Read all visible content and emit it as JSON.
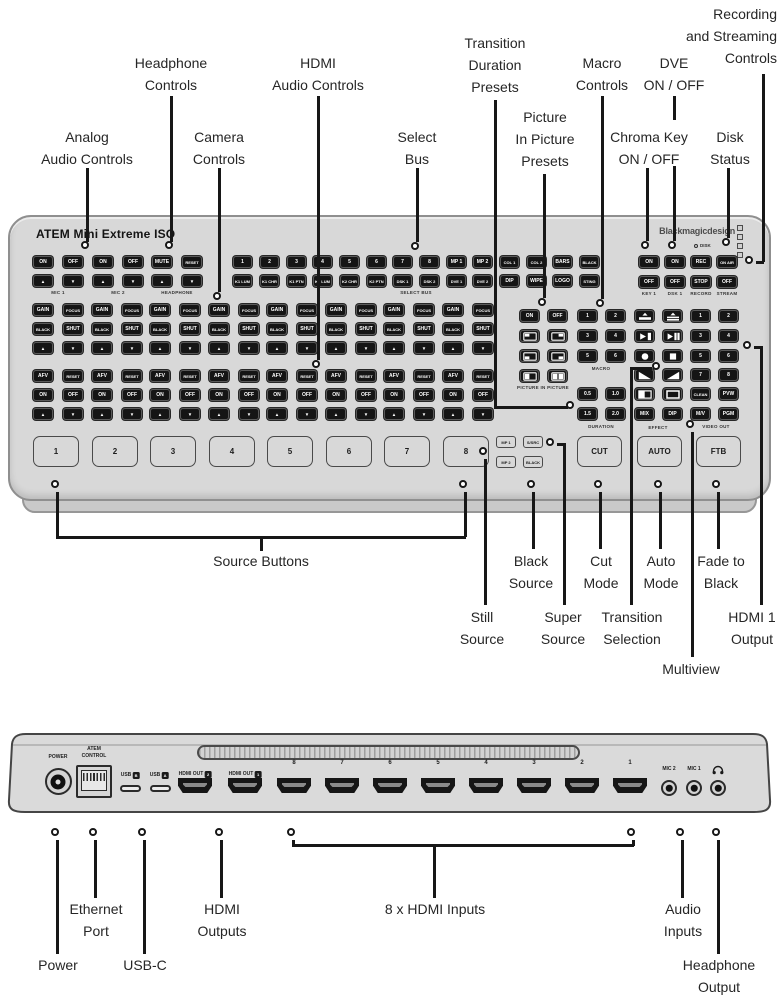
{
  "colors": {
    "panel": "#d8d8d8",
    "key": "#151515",
    "key_text": "#ffffff",
    "line": "#1a1a1a",
    "label_text": "#262626"
  },
  "front_panel": {
    "title": "ATEM Mini Extreme ISO",
    "brand": "Blackmagicdesign",
    "audio_groups": [
      {
        "label": "MIC 1",
        "rows": [
          [
            "ON",
            "OFF"
          ],
          [
            "▲",
            "▼"
          ]
        ]
      },
      {
        "label": "MIC 2",
        "rows": [
          [
            "ON",
            "OFF"
          ],
          [
            "▲",
            "▼"
          ]
        ]
      },
      {
        "label": "HEADPHONE",
        "rows": [
          [
            "MUTE",
            "RESET"
          ],
          [
            "▲",
            "▼"
          ]
        ]
      }
    ],
    "select_bus": {
      "label": "SELECT BUS",
      "row1": [
        "1",
        "2",
        "3",
        "4",
        "5",
        "6",
        "7",
        "8",
        "MP 1",
        "MP 2",
        "COL 1",
        "COL 2",
        "BARS",
        "BLACK"
      ],
      "row2": [
        "K1 LUM",
        "K1 CHR",
        "K1 PTN",
        "K2 LUM",
        "K2 CHR",
        "K2 PTN",
        "DSK 1",
        "DSK 2",
        "DVE 1",
        "DVE 2",
        "DIP",
        "WIPE",
        "LOGO",
        "STING"
      ]
    },
    "record_group": {
      "disk_led": "DISK",
      "columns": [
        {
          "top": "ON",
          "bottom": "OFF",
          "label": "KEY 1"
        },
        {
          "top": "ON",
          "bottom": "OFF",
          "label": "DSK 1"
        },
        {
          "top": "REC",
          "bottom": "STOP",
          "label": "RECORD"
        },
        {
          "top": "ON AIR",
          "bottom": "OFF",
          "label": "STREAM"
        }
      ]
    },
    "camera": {
      "columns": 8,
      "rows": [
        [
          "GAIN",
          "FOCUS"
        ],
        [
          "BLACK",
          "SHUT"
        ],
        [
          "▲",
          "▼"
        ],
        [
          "AFV",
          "RESET"
        ],
        [
          "ON",
          "OFF"
        ],
        [
          "▲",
          "▼"
        ]
      ]
    },
    "pip": {
      "label": "PICTURE IN PICTURE",
      "buttons": [
        "ON",
        "OFF"
      ],
      "icons": [
        "pip-top-left-icon",
        "pip-top-right-icon",
        "pip-bottom-left-icon",
        "pip-bottom-right-icon",
        "pip-left-half-icon",
        "pip-split-icon"
      ]
    },
    "macro": {
      "label": "MACRO",
      "buttons": [
        "1",
        "2",
        "3",
        "4",
        "5",
        "6"
      ]
    },
    "duration": {
      "label": "DURATION",
      "buttons": [
        "0.5",
        "1.0",
        "1.5",
        "2.0"
      ]
    },
    "effect": {
      "label": "EFFECT",
      "icons": [
        "wipe-up-icon",
        "squeeze-up-icon",
        "wipe-right-icon",
        "squeeze-right-icon",
        "circle-icon",
        "square-icon",
        "diagonal-wipe-left-icon",
        "diagonal-wipe-right-icon",
        "half-wipe-icon",
        "box-outline-icon"
      ],
      "buttons": [
        "MIX",
        "DIP"
      ]
    },
    "video_out": {
      "label": "VIDEO OUT",
      "buttons": [
        "1",
        "2",
        "3",
        "4",
        "5",
        "6",
        "7",
        "8",
        "CLEAN",
        "PVW",
        "M/V",
        "PGM"
      ]
    },
    "source_buttons": [
      "1",
      "2",
      "3",
      "4",
      "5",
      "6",
      "7",
      "8"
    ],
    "aux_buttons": [
      "MP 1",
      "S/SRC",
      "MP 2",
      "BLACK"
    ],
    "transport_buttons": [
      "CUT",
      "AUTO",
      "FTB"
    ]
  },
  "rear_panel": {
    "power_label": "POWER",
    "control_label_lines": [
      "ATEM",
      "CONTROL"
    ],
    "usb_b_label": "USB",
    "usb_b_letter": "B",
    "usb_a_label": "USB",
    "usb_a_letter": "A",
    "hdmi_out_2": {
      "text": "HDMI OUT",
      "num": "2"
    },
    "hdmi_out_1": {
      "text": "HDMI OUT",
      "num": "1"
    },
    "input_labels": [
      "8",
      "7",
      "6",
      "5",
      "4",
      "3",
      "2",
      "1"
    ],
    "mic_2_label": "MIC 2",
    "mic_1_label": "MIC 1"
  },
  "callouts": {
    "top": [
      {
        "id": "analog-audio",
        "lines": [
          "Analog",
          "Audio Controls"
        ]
      },
      {
        "id": "headphone-controls",
        "lines": [
          "Headphone",
          "Controls"
        ]
      },
      {
        "id": "camera-controls",
        "lines": [
          "Camera",
          "Controls"
        ]
      },
      {
        "id": "hdmi-audio",
        "lines": [
          "HDMI",
          "Audio Controls"
        ]
      },
      {
        "id": "select-bus",
        "lines": [
          "Select",
          "Bus"
        ]
      },
      {
        "id": "transition-duration",
        "lines": [
          "Transition",
          "Duration",
          "Presets"
        ]
      },
      {
        "id": "pip-presets",
        "lines": [
          "Picture",
          "In Picture",
          "Presets"
        ]
      },
      {
        "id": "macro-controls",
        "lines": [
          "Macro",
          "Controls"
        ]
      },
      {
        "id": "chroma-key",
        "lines": [
          "Chroma Key",
          "ON / OFF"
        ]
      },
      {
        "id": "dve",
        "lines": [
          "DVE",
          "ON / OFF"
        ]
      },
      {
        "id": "disk-status",
        "lines": [
          "Disk",
          "Status"
        ]
      },
      {
        "id": "rec-stream",
        "lines": [
          "Recording",
          "and Streaming",
          "Controls"
        ]
      }
    ],
    "bottom": [
      {
        "id": "source-buttons",
        "lines": [
          "Source Buttons"
        ]
      },
      {
        "id": "still-source",
        "lines": [
          "Still",
          "Source"
        ]
      },
      {
        "id": "black-source",
        "lines": [
          "Black",
          "Source"
        ]
      },
      {
        "id": "super-source",
        "lines": [
          "Super",
          "Source"
        ]
      },
      {
        "id": "cut-mode",
        "lines": [
          "Cut",
          "Mode"
        ]
      },
      {
        "id": "transition-selection",
        "lines": [
          "Transition",
          "Selection"
        ]
      },
      {
        "id": "auto-mode",
        "lines": [
          "Auto",
          "Mode"
        ]
      },
      {
        "id": "multiview",
        "lines": [
          "Multiview"
        ]
      },
      {
        "id": "fade-to-black",
        "lines": [
          "Fade to",
          "Black"
        ]
      },
      {
        "id": "hdmi1-output",
        "lines": [
          "HDMI 1",
          "Output"
        ]
      }
    ],
    "rear": [
      {
        "id": "power",
        "lines": [
          "Power"
        ]
      },
      {
        "id": "ethernet",
        "lines": [
          "Ethernet",
          "Port"
        ]
      },
      {
        "id": "usb-c",
        "lines": [
          "USB-C"
        ]
      },
      {
        "id": "hdmi-outputs",
        "lines": [
          "HDMI",
          "Outputs"
        ]
      },
      {
        "id": "hdmi-inputs",
        "lines": [
          "8 x HDMI Inputs"
        ]
      },
      {
        "id": "audio-inputs",
        "lines": [
          "Audio",
          "Inputs"
        ]
      },
      {
        "id": "headphone-output",
        "lines": [
          "Headphone",
          "Output"
        ]
      }
    ]
  }
}
